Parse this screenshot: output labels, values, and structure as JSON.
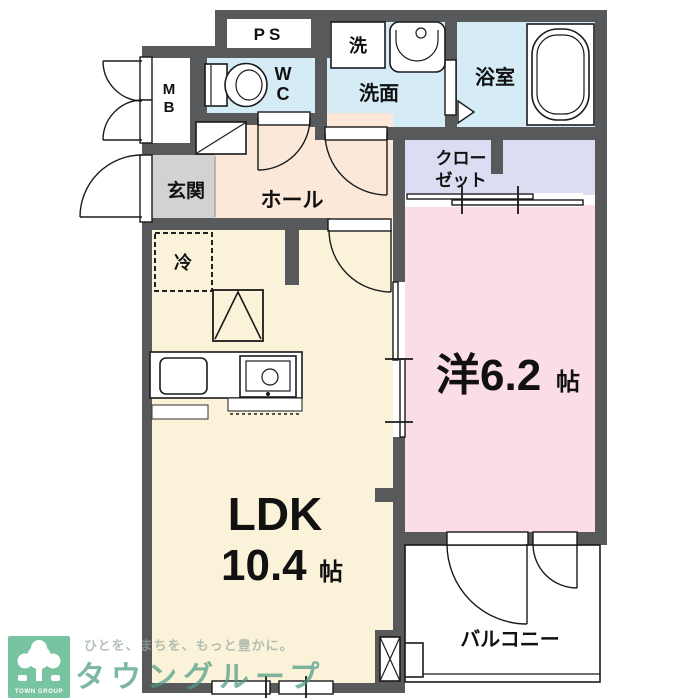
{
  "rooms": {
    "ps": "PS",
    "meter_box": {
      "line1": "M",
      "line2": "B"
    },
    "toilet": {
      "line1": "W",
      "line2": "C"
    },
    "washer": "洗",
    "washroom": "洗面",
    "bathroom": "浴室",
    "entrance": "玄関",
    "hall": "ホール",
    "closet": {
      "line1": "クロー",
      "line2": "ゼット"
    },
    "fridge": "冷",
    "western_room": {
      "name": "洋6.2",
      "unit": "帖"
    },
    "ldk": {
      "name": "LDK",
      "size": "10.4",
      "unit": "帖"
    },
    "balcony": "バルコニー"
  },
  "watermark": {
    "logo": "TOWN GROUP",
    "tagline": "ひとを、まちを、もっと豊かに。",
    "brand": "タウングループ"
  },
  "colors": {
    "wall": "#58595b",
    "wet_room": "#d5ecf6",
    "closet": "#dcdcf3",
    "western": "#fadde9",
    "hall": "#fce8d8",
    "ldk": "#faf3da",
    "entrance": "#d2d2d2",
    "line": "#1a1a1a",
    "text": "#111111",
    "logo_green": "#67bc93",
    "brand_teal": "#4f9c85",
    "tagline_gray": "#97a8a1"
  }
}
